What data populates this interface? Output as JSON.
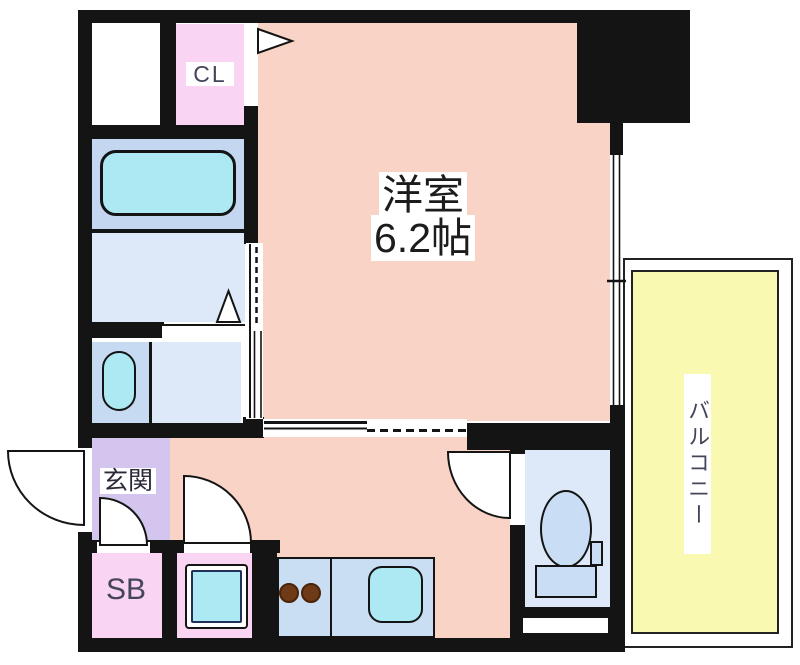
{
  "floorplan": {
    "rooms": {
      "main": {
        "name": "洋室",
        "size": "6.2帖"
      },
      "closet": {
        "label": "CL"
      },
      "entrance": {
        "label": "玄関"
      },
      "shoe_box": {
        "label": "SB"
      },
      "balcony": {
        "label": "バルコニー"
      }
    },
    "fixtures": [
      "bathtub",
      "wash-basin",
      "washing-machine-pan",
      "kitchen-counter",
      "gas-burners",
      "kitchen-sink",
      "toilet"
    ],
    "colors": {
      "wall_black": "#141414",
      "main_room_peach": "#f9d3c5",
      "closet_pink": "#f9d5f3",
      "entrance_purple": "#d3c5ee",
      "bath_blue": "#c3d8f0",
      "sanitary_blue": "#dde9f8",
      "vanity_blue": "#c6daf2",
      "counter_blue": "#c9def2",
      "fixture_cyan": "#ace9f2",
      "toilet_fill": "#c9ddf5",
      "balcony_yellow": "#f9f9b2",
      "burner_brown": "#6e3a17"
    }
  }
}
